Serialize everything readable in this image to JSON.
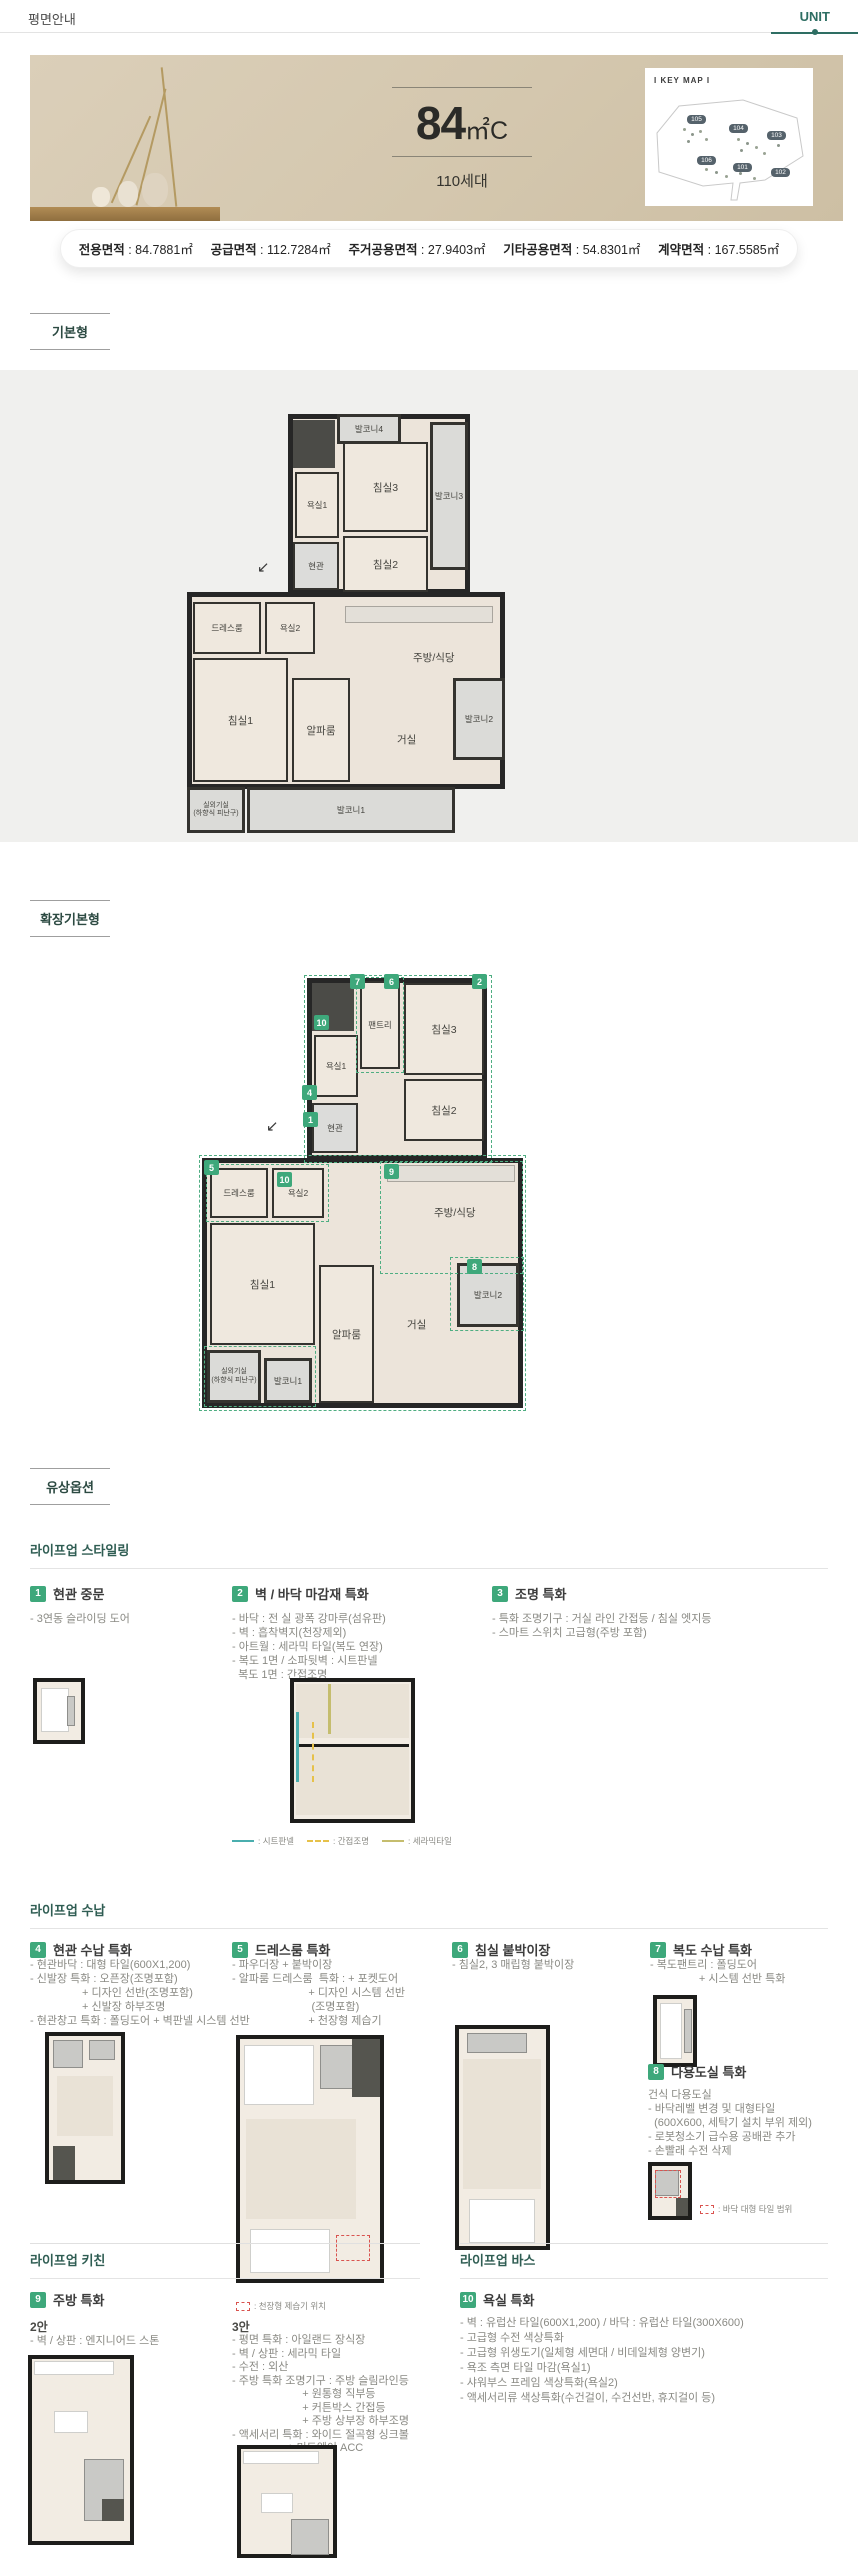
{
  "colors": {
    "accent_green": "#3ea87b",
    "teal": "#2e6e63",
    "banner_beige": "#d4c7ae",
    "wall": "#262626"
  },
  "header": {
    "title": "평면안내",
    "tab": "UNIT"
  },
  "hero": {
    "unit_main": "84",
    "unit_sub": "㎡C",
    "households": "110세대",
    "keymap_title": "I KEY MAP I",
    "keymap_labels": [
      "105",
      "104",
      "103",
      "106",
      "101",
      "102"
    ]
  },
  "area_info": {
    "items": [
      {
        "label": "전용면적",
        "value": "84.7881㎡"
      },
      {
        "label": "공급면적",
        "value": "112.7284㎡"
      },
      {
        "label": "주거공용면적",
        "value": "27.9403㎡"
      },
      {
        "label": "기타공용면적",
        "value": "54.8301㎡"
      },
      {
        "label": "계약면적",
        "value": "167.5585㎡"
      }
    ]
  },
  "section_labels": {
    "basic": "기본형",
    "extended": "확장기본형",
    "paid": "유상옵션"
  },
  "plan_basic": {
    "rooms": [
      "발코니4",
      "침실3",
      "발코니3",
      "욕실1",
      "현관",
      "침실2",
      "드레스룸",
      "욕실2",
      "주방/식당",
      "침실1",
      "알파룸",
      "거실",
      "발코니2",
      "실외기실",
      "(하향식 피난구)",
      "발코니1"
    ],
    "entry_arrow": "↙"
  },
  "plan_extended": {
    "rooms": [
      "팬트리",
      "침실3",
      "욕실1",
      "현관",
      "침실2",
      "드레스룸",
      "욕실2",
      "주방/식당",
      "침실1",
      "알파룸",
      "거실",
      "발코니2",
      "실외기실",
      "(하향식 피난구)",
      "발코니1"
    ],
    "badges": [
      "7",
      "6",
      "2",
      "10",
      "4",
      "1",
      "5",
      "10",
      "9",
      "8"
    ],
    "entry_arrow": "↙"
  },
  "styling": {
    "heading": "라이프업 스타일링",
    "items": [
      {
        "num": "1",
        "title": "현관 중문",
        "bullets": [
          "- 3연동 슬라이딩 도어"
        ]
      },
      {
        "num": "2",
        "title": "벽 / 바닥 마감재 특화",
        "bullets": [
          "- 바닥 : 전 실 광폭 강마루(섬유판)",
          "- 벽 : 흡착벽지(천장제외)",
          "- 아트월 : 세라믹 타일(복도 연장)",
          "- 복도 1면 / 소파뒷벽 : 시트판넬",
          "  복도 1면 : 간접조명"
        ],
        "legend": [
          ": 시트판넬",
          ": 간접조명",
          ": 세라믹타일"
        ]
      },
      {
        "num": "3",
        "title": "조명 특화",
        "bullets": [
          "- 특화 조명기구 : 거실 라인 간접등 / 침실 엣지등",
          "- 스마트 스위치 고급형(주방 포함)"
        ]
      }
    ]
  },
  "storage": {
    "heading": "라이프업 수납",
    "items": [
      {
        "num": "4",
        "title": "현관 수납 특화",
        "bullets": [
          "- 현관바닥 : 대형 타일(600X1,200)",
          "- 신발장 특화 : 오픈장(조명포함)",
          "                 + 디자인 선반(조명포함)",
          "                 + 신발장 하부조명",
          "- 현관창고 특화 : 폴딩도어 + 벽판넬 시스템 선반"
        ]
      },
      {
        "num": "5",
        "title": "드레스룸 특화",
        "bullets": [
          "- 파우더장 + 붙박이장",
          "- 알파룸 드레스룸  특화 : + 포켓도어",
          "                         + 디자인 시스템 선반",
          "                          (조명포함)",
          "                         + 천장형 제습기"
        ],
        "legend": ": 천장형 제습기 위치"
      },
      {
        "num": "6",
        "title": "침실 붙박이장",
        "bullets": [
          "- 침실2, 3 매립형 붙박이장"
        ]
      },
      {
        "num": "7",
        "title": "복도 수납 특화",
        "bullets": [
          "- 복도팬트리 : 폴딩도어",
          "                + 시스템 선반 특화"
        ]
      },
      {
        "num": "8",
        "title": "다용도실 특화",
        "bullets": [
          "건식 다용도실",
          "- 바닥레벨 변경 및 대형타일",
          "  (600X600, 세탁기 설치 부위 제외)",
          "- 로봇청소기 급수용 공배관 추가",
          "- 손빨래 수전 삭제"
        ],
        "legend": ": 바닥 대형 타일 범위"
      }
    ]
  },
  "kitchen": {
    "heading": "라이프업 키친",
    "num": "9",
    "title": "주방 특화",
    "option2": {
      "label": "2안",
      "bullets": [
        "- 벽 / 상판 : 엔지니어드 스톤"
      ]
    },
    "option3": {
      "label": "3안",
      "bullets": [
        "- 평면 특화 : 아일랜드 장식장",
        "- 벽 / 상판 : 세라믹 타일",
        "- 수전 : 외산",
        "- 주방 특화 조명기구 : 주방 슬림라인등",
        "                       + 원통형 직부등",
        "                       + 커튼박스 간접등",
        "                       + 주방 상부장 하부조명",
        "- 액세서리 특화 : 와이드 절곡형 싱크볼",
        "                  + 미드웨이 ACC"
      ]
    }
  },
  "bath": {
    "heading": "라이프업 바스",
    "num": "10",
    "title": "욕실 특화",
    "bullets": [
      "- 벽 : 유럽산 타일(600X1,200) / 바닥 : 유럽산 타일(300X600)",
      "- 고급형 수전 색상특화",
      "- 고급형 위생도기(일체형 세면대 / 비데일체형 양변기)",
      "- 욕조 측면 타일 마감(욕실1)",
      "- 샤워부스 프레임 색상특화(욕실2)",
      "- 액세서리류 색상특화(수건걸이, 수건선반, 휴지걸이 등)"
    ]
  }
}
